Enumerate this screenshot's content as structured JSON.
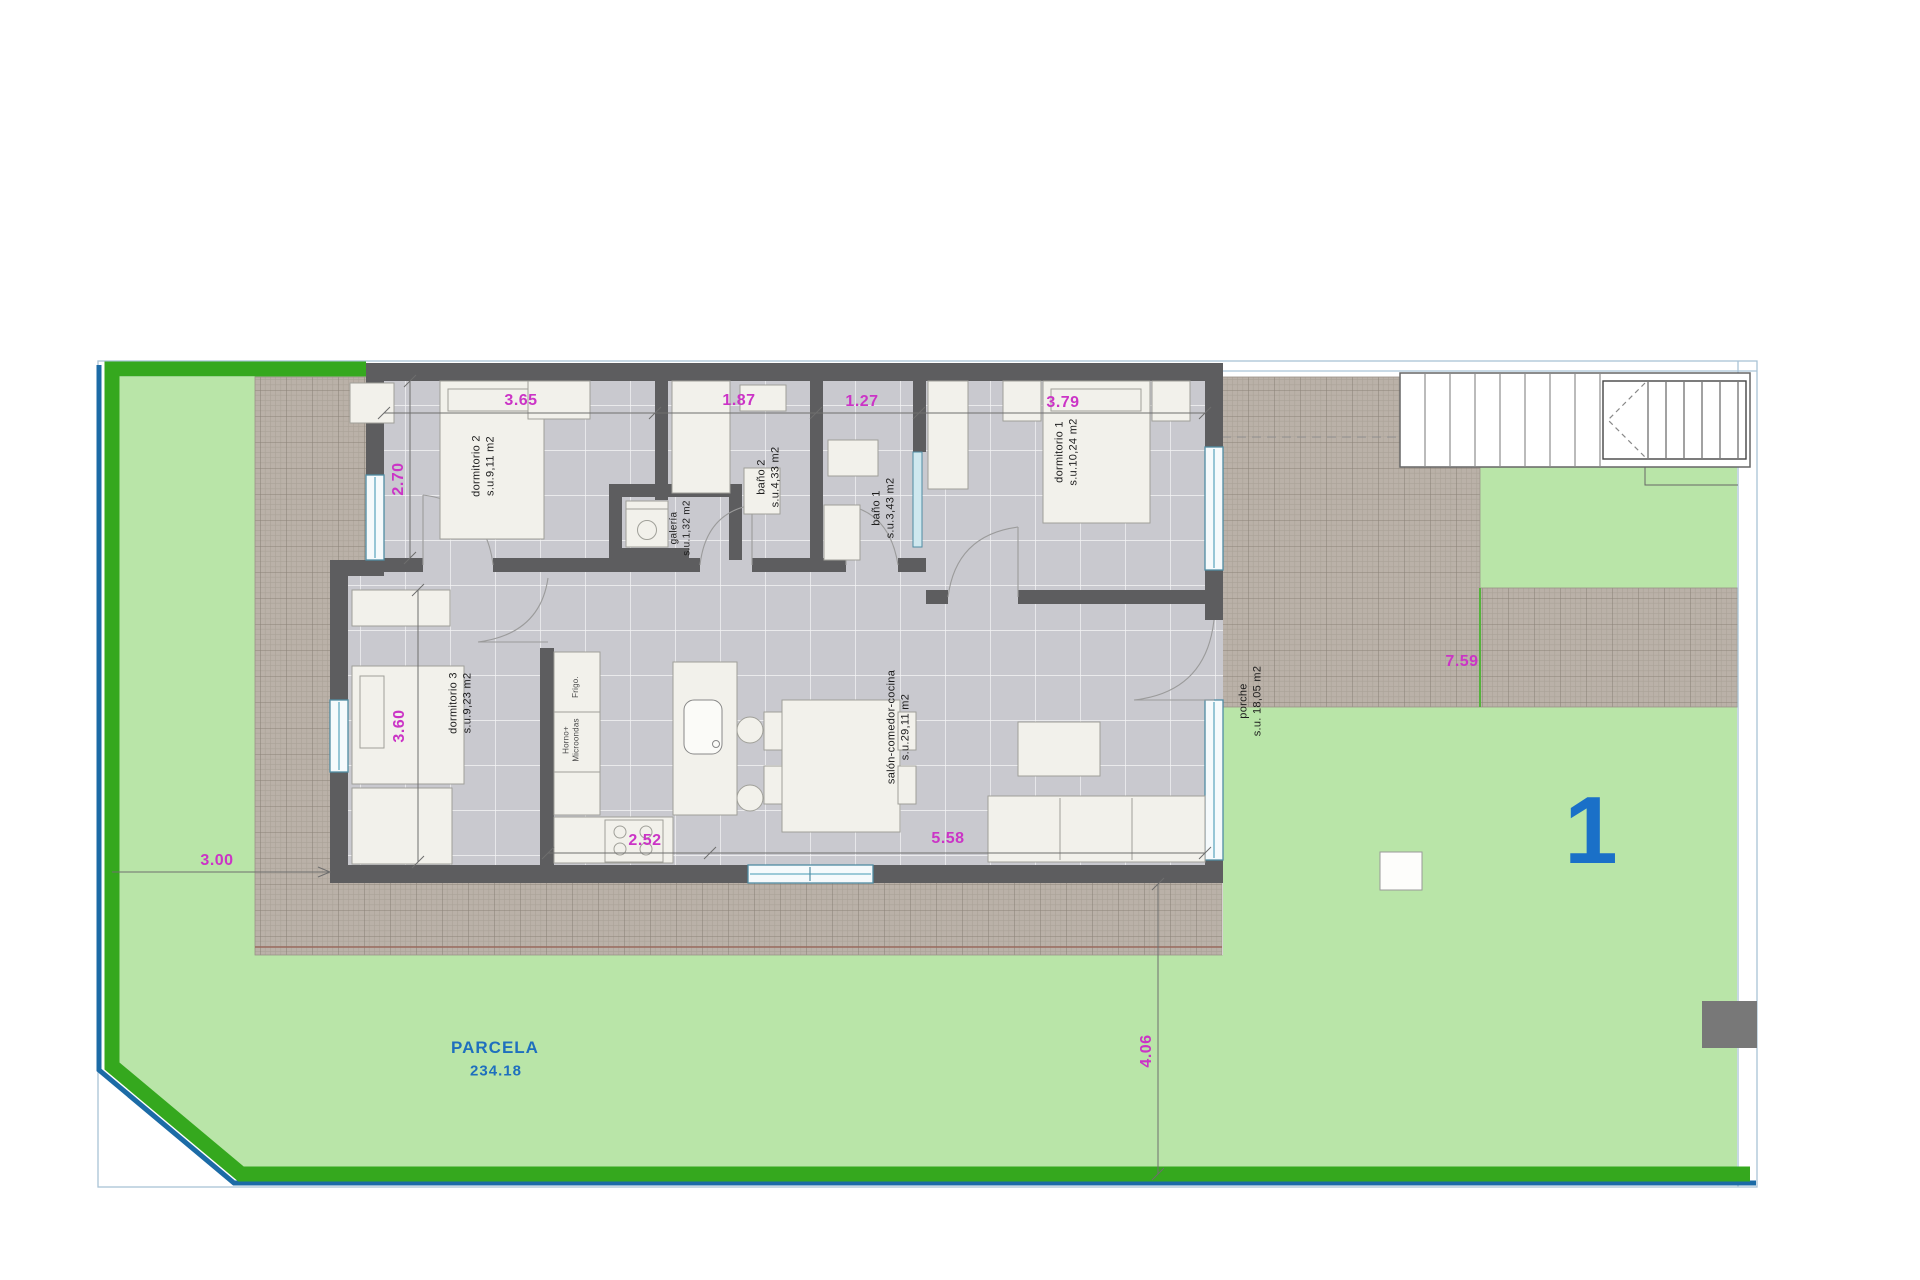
{
  "colors": {
    "lawn": "#b9e5a8",
    "fence_green": "#35a81e",
    "fence_blue": "#1c6ba6",
    "wall": "#5d5d5f",
    "terrace_hatch": "#bab1a8",
    "floor_tile": "#c9c9cf",
    "dimension_magenta": "#cb34c6",
    "label_blue": "#1e6fbe",
    "unit_blue": "#1a70c8",
    "window_blue": "#7fb9cc"
  },
  "parcel": {
    "name": "PARCELA",
    "area": "234.18",
    "unit": "1"
  },
  "rooms": [
    {
      "label": "dormitorio 2",
      "area": "s.u.9,11 m2"
    },
    {
      "label": "baño 2",
      "area": "s.u.4,33 m2"
    },
    {
      "label": "galería",
      "area": "s.u.1,32 m2"
    },
    {
      "label": "baño 1",
      "area": "s.u.3,43 m2"
    },
    {
      "label": "dormitorio 1",
      "area": "s.u.10,24 m2"
    },
    {
      "label": "dormitorio 3",
      "area": "s.u.9,23 m2"
    },
    {
      "label": "salón-comedor-cocina",
      "area": "s.u.29,11 m2"
    },
    {
      "label": "porche",
      "area": "s.u. 18,05 m2"
    }
  ],
  "kitchen": {
    "fridge": "Frigo.",
    "oven_line1": "Horno+",
    "oven_line2": "Microondas"
  },
  "dimensions": {
    "dorm2_w": "3.65",
    "bano2_w": "1.87",
    "bano1_w": "1.27",
    "dorm1_w": "3.79",
    "dorm2_h": "2.70",
    "dorm3_h": "3.60",
    "kitchen_w": "2.52",
    "salon_w": "5.58",
    "west_setback": "3.00",
    "east_walk": "7.59",
    "south_setback": "4.06"
  }
}
